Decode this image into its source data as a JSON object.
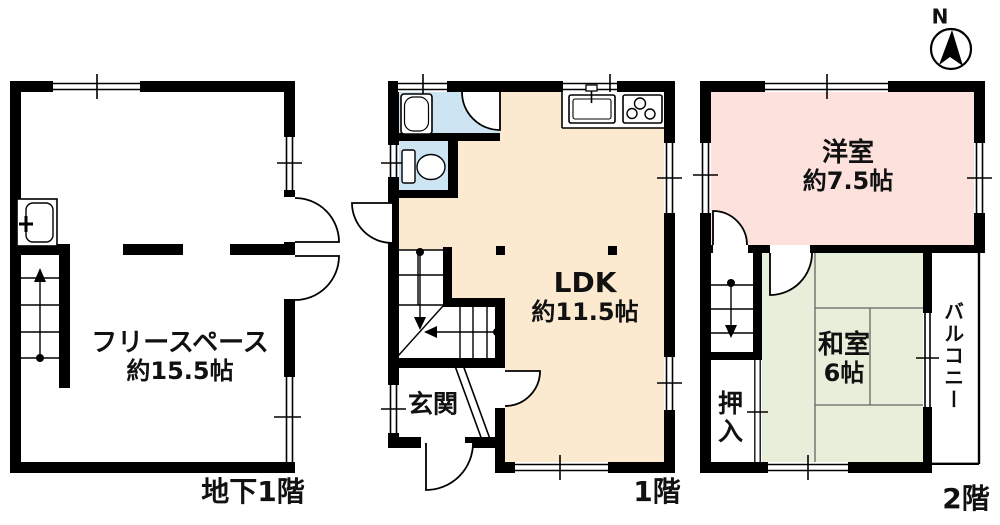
{
  "compass": {
    "north_label": "N"
  },
  "colors": {
    "wall": "#000000",
    "ldk_fill": "#fbead0",
    "wet_area_fill": "#cde4f3",
    "western_room_fill": "#fce1dc",
    "tatami_room_fill": "#e7eeda"
  },
  "floors": {
    "basement": {
      "label": "地下1階",
      "free_space": {
        "name": "フリースペース",
        "size": "約15.5帖"
      }
    },
    "first": {
      "label": "1階",
      "ldk": {
        "name": "LDK",
        "size": "約11.5帖"
      },
      "entrance": {
        "name": "玄関"
      }
    },
    "second": {
      "label": "2階",
      "western_room": {
        "name": "洋室",
        "size": "約7.5帖"
      },
      "japanese_room": {
        "name": "和室",
        "size": "6帖"
      },
      "closet": {
        "name": "押入"
      },
      "balcony": {
        "name": "バルコニー"
      }
    }
  }
}
